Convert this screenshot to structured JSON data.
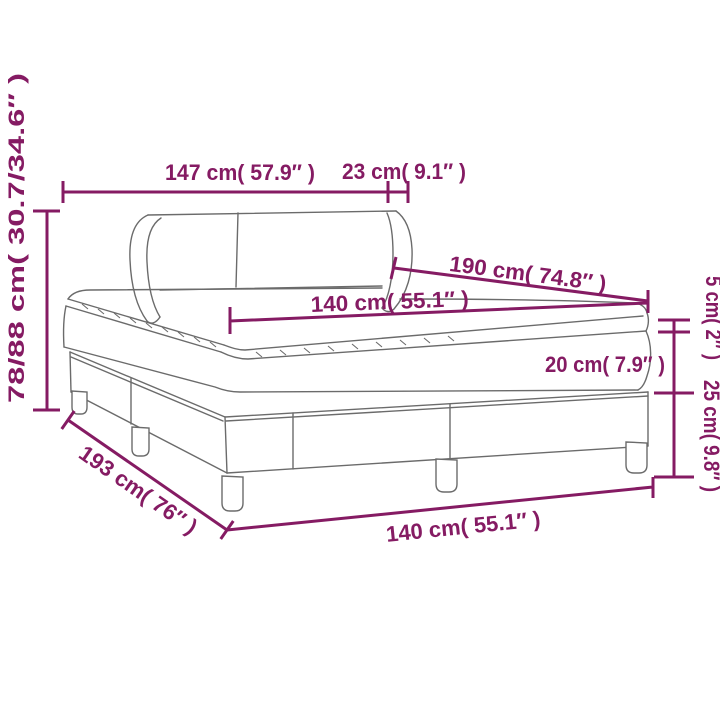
{
  "page": {
    "background": "#ffffff"
  },
  "colors": {
    "dimension": "#851b63",
    "drawing": "#6b6b6b"
  },
  "diagram": {
    "type": "product-dimension-line-drawing",
    "subject": "box spring bed with headboard, mattress and topper",
    "labels": {
      "headboard_width": "147 cm( 57.9″ )",
      "headboard_wing": "23 cm( 9.1″ )",
      "mattress_length": "190 cm( 74.8″ )",
      "mattress_width_top": "140 cm( 55.1″ )",
      "total_height": "78/88 cm( 30.7/34.6″ )",
      "topper_height": "5 cm( 2″ )",
      "mattress_height": "20 cm( 7.9″ )",
      "base_height": "25 cm( 9.8″ )",
      "frame_length": "193 cm( 76″ )",
      "frame_width_bottom": "140 cm( 55.1″ )"
    }
  }
}
